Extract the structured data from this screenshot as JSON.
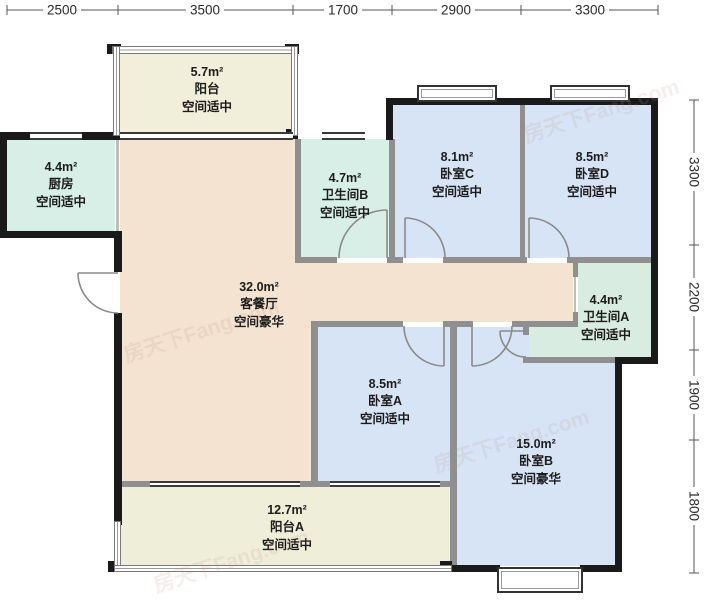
{
  "watermark": "房天下Fang.com",
  "dimensions": {
    "top": [
      "2500",
      "3500",
      "1700",
      "2900",
      "3300"
    ],
    "right": [
      "3300",
      "2200",
      "1900",
      "1800"
    ]
  },
  "rooms": [
    {
      "id": "balcony-top",
      "area": "5.7m²",
      "name": "阳台",
      "quality": "空间适中"
    },
    {
      "id": "kitchen",
      "area": "4.4m²",
      "name": "厨房",
      "quality": "空间适中"
    },
    {
      "id": "bathroom-b",
      "area": "4.7m²",
      "name": "卫生间B",
      "quality": "空间适中"
    },
    {
      "id": "bedroom-c",
      "area": "8.1m²",
      "name": "卧室C",
      "quality": "空间适中"
    },
    {
      "id": "bedroom-d",
      "area": "8.5m²",
      "name": "卧室D",
      "quality": "空间适中"
    },
    {
      "id": "living",
      "area": "32.0m²",
      "name": "客餐厅",
      "quality": "空间豪华"
    },
    {
      "id": "bathroom-a",
      "area": "4.4m²",
      "name": "卫生间A",
      "quality": "空间适中"
    },
    {
      "id": "bedroom-a",
      "area": "8.5m²",
      "name": "卧室A",
      "quality": "空间适中"
    },
    {
      "id": "bedroom-b",
      "area": "15.0m²",
      "name": "卧室B",
      "quality": "空间豪华"
    },
    {
      "id": "balcony-a",
      "area": "12.7m²",
      "name": "阳台A",
      "quality": "空间适中"
    }
  ],
  "colors": {
    "bedroom_fill": "#d7e4f6",
    "bath_kitchen_fill": "#d8efe8",
    "bathroom_a_fill": "#d9ece1",
    "living_fill": "#f5e3d1",
    "balcony_fill": "#f1eed9",
    "exterior_wall": "#1a1a1a",
    "interior_wall": "#8f8f8f"
  }
}
